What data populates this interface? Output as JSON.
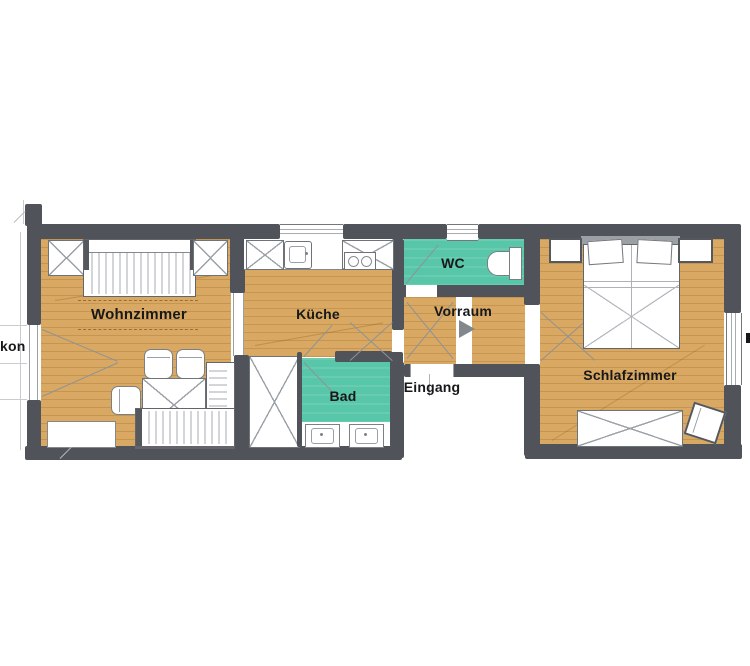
{
  "drawing": {
    "kind": "apartment floor plan sketch",
    "rooms": {
      "wohnzimmer": {
        "label": "Wohnzimmer"
      },
      "kueche": {
        "label": "Küche"
      },
      "wc": {
        "label": "WC"
      },
      "vorraum": {
        "label": "Vorraum"
      },
      "eingang": {
        "label": "Eingang"
      },
      "bad": {
        "label": "Bad"
      },
      "schlafzimmer": {
        "label": "Schlafzimmer"
      },
      "balkon_left_partial": {
        "label": "kon"
      }
    },
    "colors": {
      "wall": "#50545a",
      "wood_floor": "#d9a862",
      "wet_room_green": "#58c6a8",
      "background": "#ffffff",
      "label_text": "#17181a"
    }
  }
}
